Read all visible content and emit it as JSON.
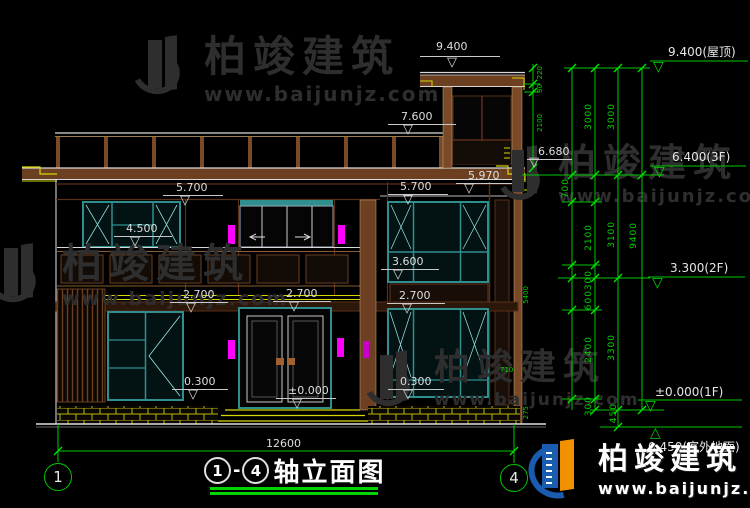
{
  "title": {
    "axis_start": "1",
    "axis_end": "4",
    "name": "轴立面图"
  },
  "axis": {
    "left": "1",
    "right": "4"
  },
  "watermark": {
    "brand": "柏竣建筑",
    "url": "www.baijunjz.com"
  },
  "logo": {
    "brand": "柏竣建筑",
    "url": "www.baijunjz.com"
  },
  "labels": {
    "e9400": "9.400",
    "e7600": "7.600",
    "e6680": "6.680",
    "e5970": "5.970",
    "e5700a": "5.700",
    "e5700b": "5.700",
    "e4500": "4.500",
    "e3600": "3.600",
    "e2700a": "2.700",
    "e2700b": "2.700",
    "e2700c": "2.700",
    "e0300a": "0.300",
    "e0300b": "0.300",
    "e0000": "±0.000",
    "dim_total_h": "12600"
  },
  "levels": {
    "roof": "9.400(屋顶)",
    "f3": "6.400(3F)",
    "f2": "3.300(2F)",
    "f1": "±0.000(1F)",
    "outdoor": "0.450(室外地面)"
  },
  "chains": {
    "c3000a": "3000",
    "c700": "700",
    "c2100": "2100",
    "c300a": "300",
    "c600": "600",
    "c2400": "2400",
    "c300b": "300",
    "c3000b": "3000",
    "c3100": "3100",
    "c3300": "3300",
    "c450": "450",
    "c9400": "9400",
    "b220": "220",
    "b30": "30",
    "b2100": "2100",
    "m5400": "5400",
    "m275": "275",
    "m710": "710"
  },
  "colors": {
    "dim_green": "#00c800",
    "line_white": "#d8d8d8",
    "frame_teal": "#2f8f8f",
    "accent_yellow": "#d6d600",
    "lamp_magenta": "#ff00ff",
    "wall_brown": "#7a4a28",
    "logo_blue": "#1a5cb0",
    "logo_orange": "#f29100"
  }
}
